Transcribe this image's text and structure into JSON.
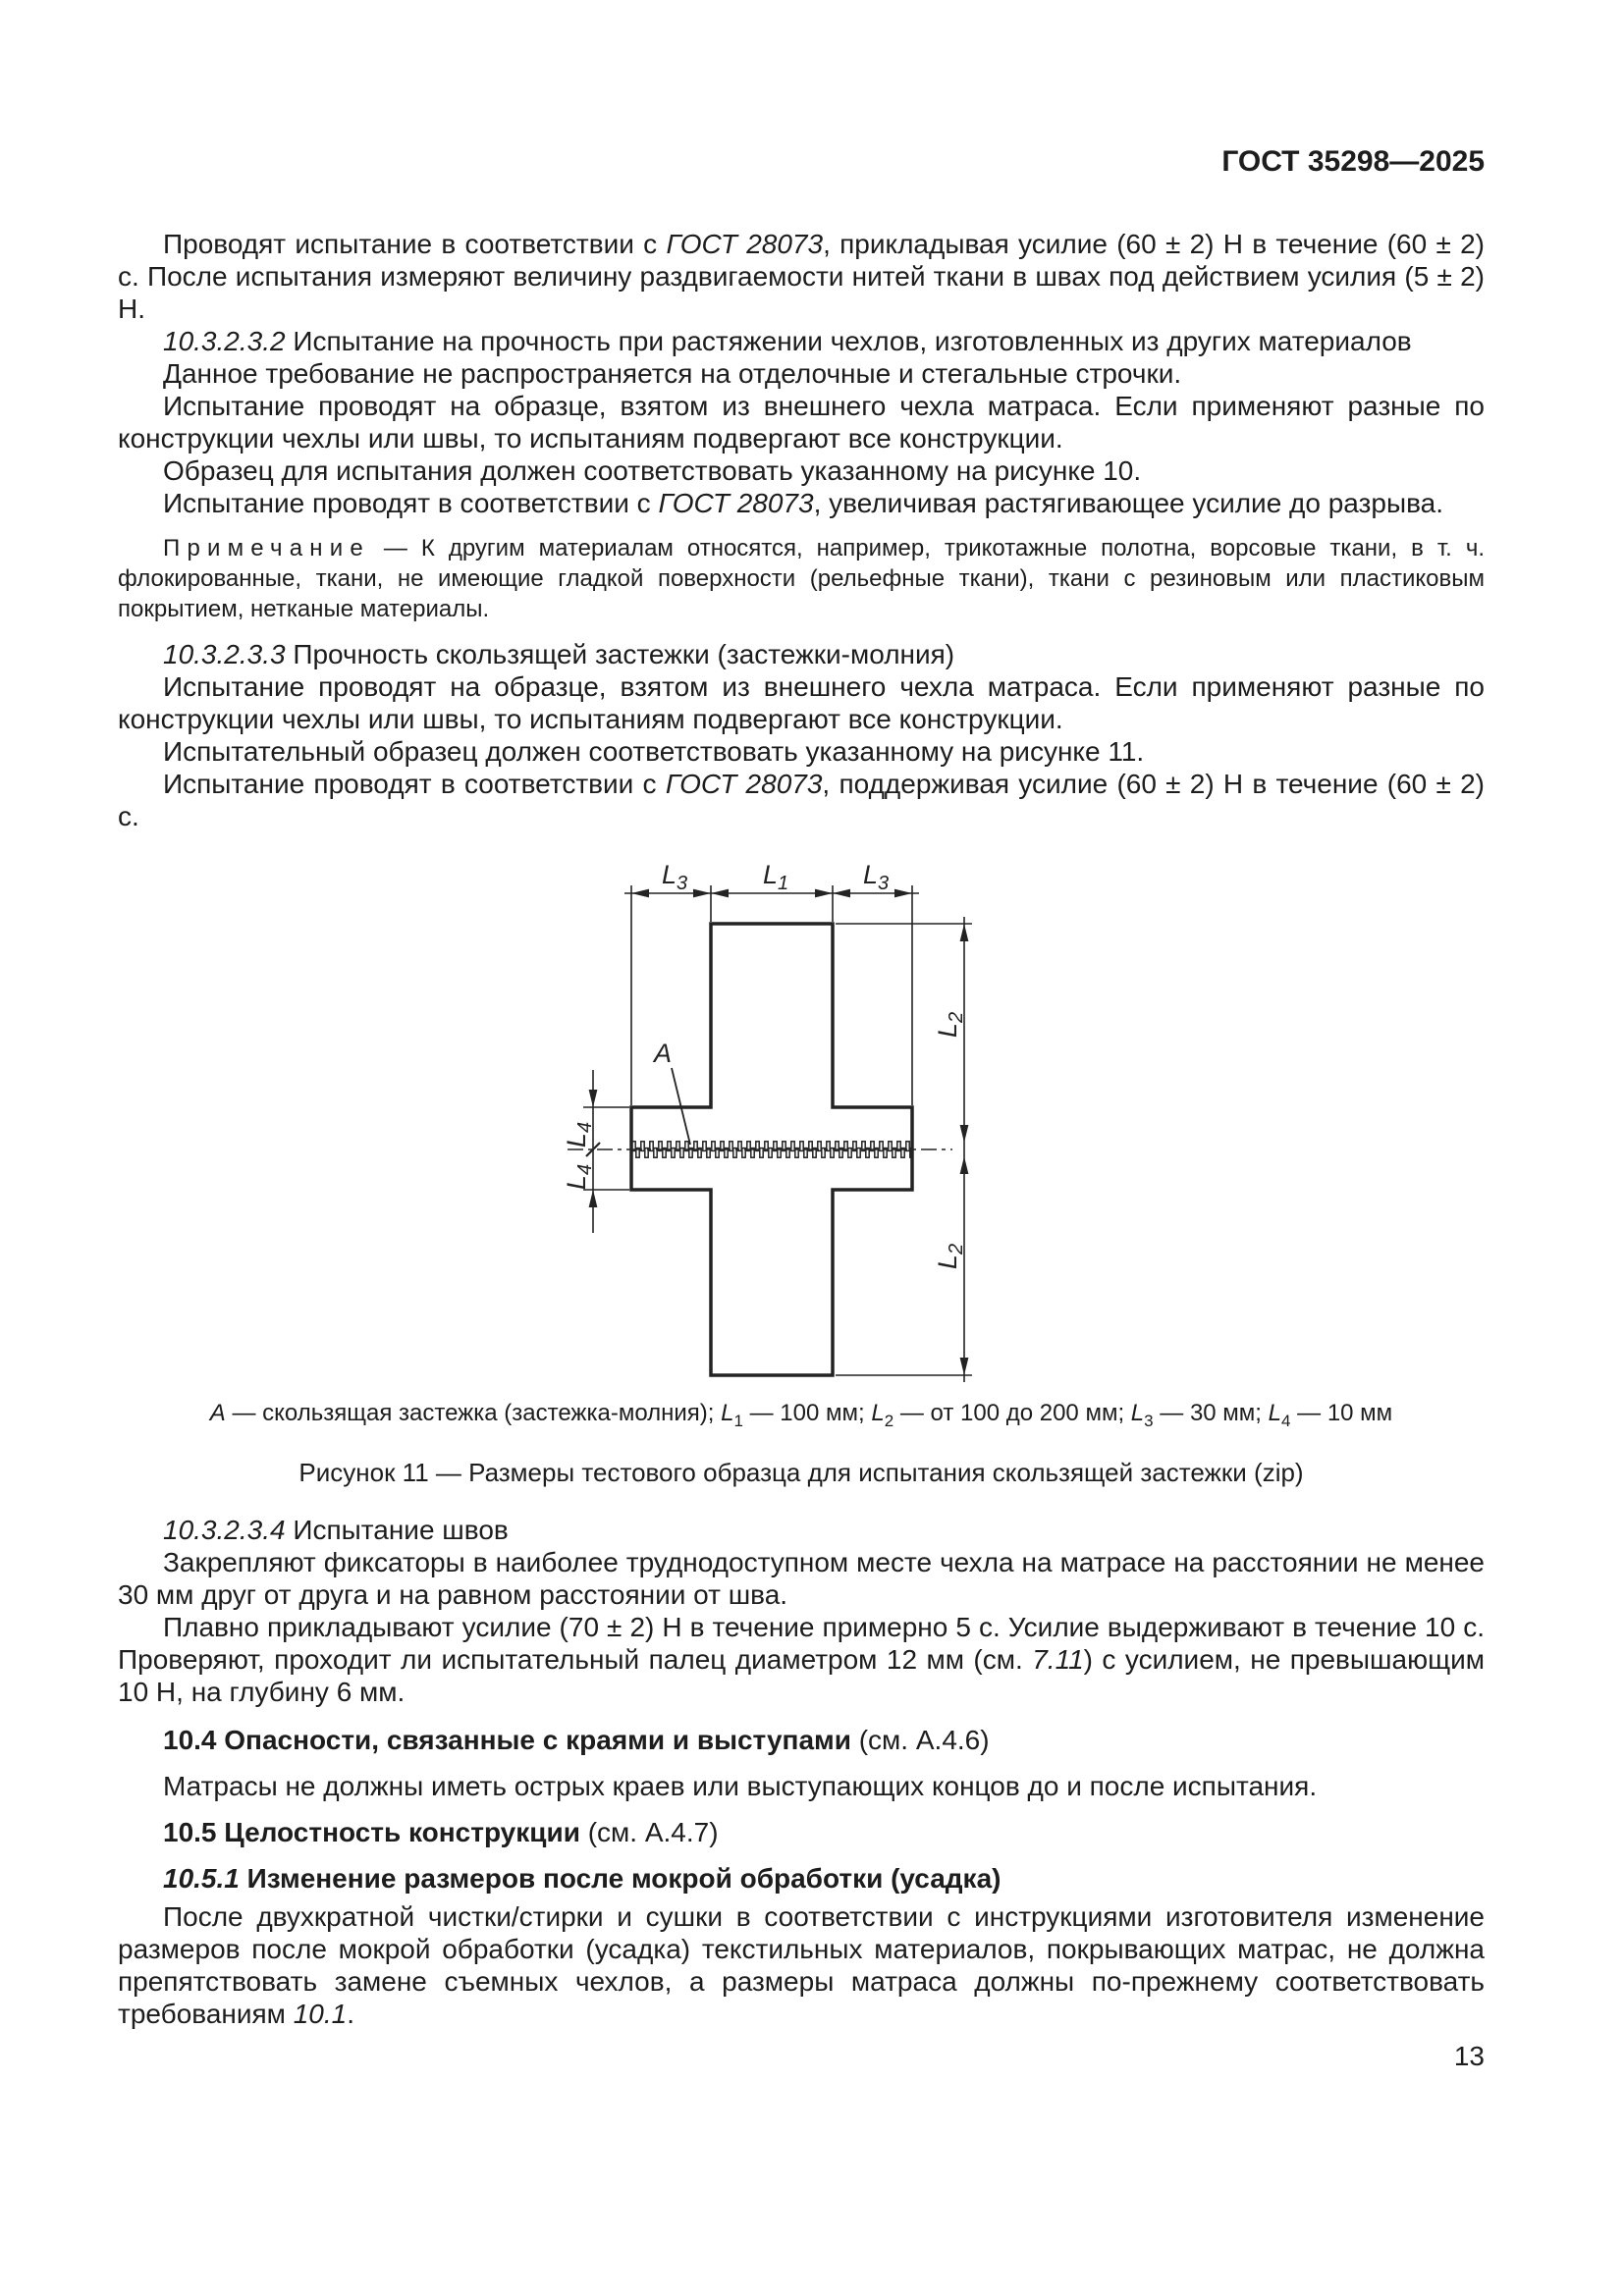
{
  "header": {
    "standard": "ГОСТ 35298—2025"
  },
  "body": {
    "p1a": "Проводят испытание в соответствии с ",
    "p1b": "ГОСТ 28073",
    "p1c": ", прикладывая усилие (60 ± 2) Н в течение (60 ± 2) с. После испытания измеряют величину раздвигаемости нитей ткани в швах под действием усилия (5 ± 2) Н.",
    "h2332_num": "10.3.2.3.2",
    "h2332_title": " Испытание на прочность при растяжении чехлов, изготовленных из других материалов",
    "p2": "Данное требование не распространяется на отделочные и стегальные строчки.",
    "p3": "Испытание проводят на образце, взятом из внешнего чехла матраса. Если применяют разные по конструкции чехлы или швы, то испытаниям подвергают все конструкции.",
    "p4": "Образец для испытания должен соответствовать указанному на рисунке 10.",
    "p5a": "Испытание проводят в соответствии с ",
    "p5b": "ГОСТ 28073",
    "p5c": ", увеличивая растягивающее усилие до разрыва.",
    "note_label": "Примечание",
    "note_text": " — К другим материалам относятся, например, трикотажные полотна, ворсовые ткани, в т. ч. флокированные, ткани, не имеющие гладкой поверхности (рельефные ткани), ткани с резиновым или пластиковым покрытием, нетканые материалы.",
    "h2333_num": "10.3.2.3.3",
    "h2333_title": " Прочность скользящей застежки (застежки-молния)",
    "p6": "Испытание проводят на образце, взятом из внешнего чехла матраса. Если применяют разные по конструкции чехлы или швы, то испытаниям подвергают все конструкции.",
    "p7": "Испытательный образец должен соответствовать указанному на рисунке 11.",
    "p8a": "Испытание проводят в соответствии с ",
    "p8b": "ГОСТ 28073",
    "p8c": ", поддерживая усилие (60 ± 2) Н в течение (60 ± 2) с."
  },
  "figure": {
    "labels": {
      "l": "L",
      "sub1": "1",
      "sub2": "2",
      "sub3": "3",
      "sub4": "4",
      "a": "A"
    },
    "legend": {
      "a": "А",
      "a_rest": " — скользящая застежка (застежка-молния); ",
      "l": "L",
      "s1": "1",
      "v1": " — 100 мм; ",
      "s2": "2",
      "v2": " — от 100 до 200 мм; ",
      "s3": "3",
      "v3": " — 30 мм; ",
      "s4": "4",
      "v4": " — 10 мм"
    },
    "caption": "Рисунок 11 — Размеры тестового образца для испытания скользящей застежки (zip)"
  },
  "sections": {
    "h2334_num": "10.3.2.3.4",
    "h2334_title": " Испытание швов",
    "p9": "Закрепляют фиксаторы в наиболее труднодоступном месте чехла на матрасе на расстоянии не менее 30 мм друг от друга и на равном расстоянии от шва.",
    "p10a": "Плавно прикладывают усилие (70 ± 2) Н в течение примерно 5 с. Усилие выдерживают в течение 10 с. Проверяют, проходит ли испытательный палец диаметром 12 мм (см. ",
    "p10b": "7.11",
    "p10c": ") с усилием, не превышающим 10 Н, на глубину 6 мм.",
    "h104_title": "10.4 Опасности, связанные с краями и выступами",
    "h104_ref": " (см. А.4.6)",
    "p11": "Матрасы не должны иметь острых краев или выступающих концов до и после испытания.",
    "h105_title": "10.5 Целостность конструкции",
    "h105_ref": " (см. А.4.7)",
    "h1051_num": "10.5.1",
    "h1051_title": " Изменение размеров после мокрой обработки (усадка)",
    "p12a": "После двухкратной чистки/стирки и сушки в соответствии с инструкциями изготовителя изменение размеров после мокрой обработки (усадка) текстильных материалов, покрывающих матрас, не должна препятствовать замене съемных чехлов, а размеры матраса должны по-прежнему соответствовать требованиям ",
    "p12b": "10.1",
    "p12c": "."
  },
  "footer": {
    "page_number": "13"
  }
}
